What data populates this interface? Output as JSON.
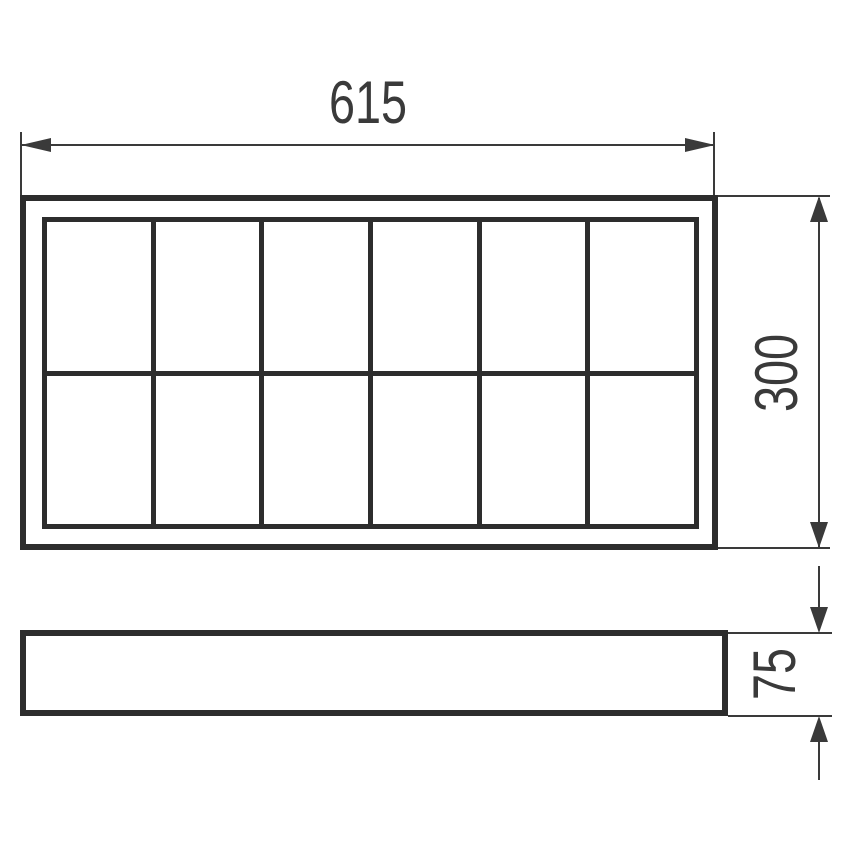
{
  "diagram": {
    "kind": "technical-dimension-drawing",
    "views": {
      "front_view": {
        "grid_columns": 6,
        "grid_rows": 2
      },
      "side_view": {}
    }
  },
  "dimensions": {
    "width": "615",
    "height": "300",
    "depth": "75"
  },
  "colors": {
    "line": "#3a3a3a",
    "frame": "#2d2d2d",
    "background": "#ffffff",
    "text": "#3a3a3a"
  }
}
